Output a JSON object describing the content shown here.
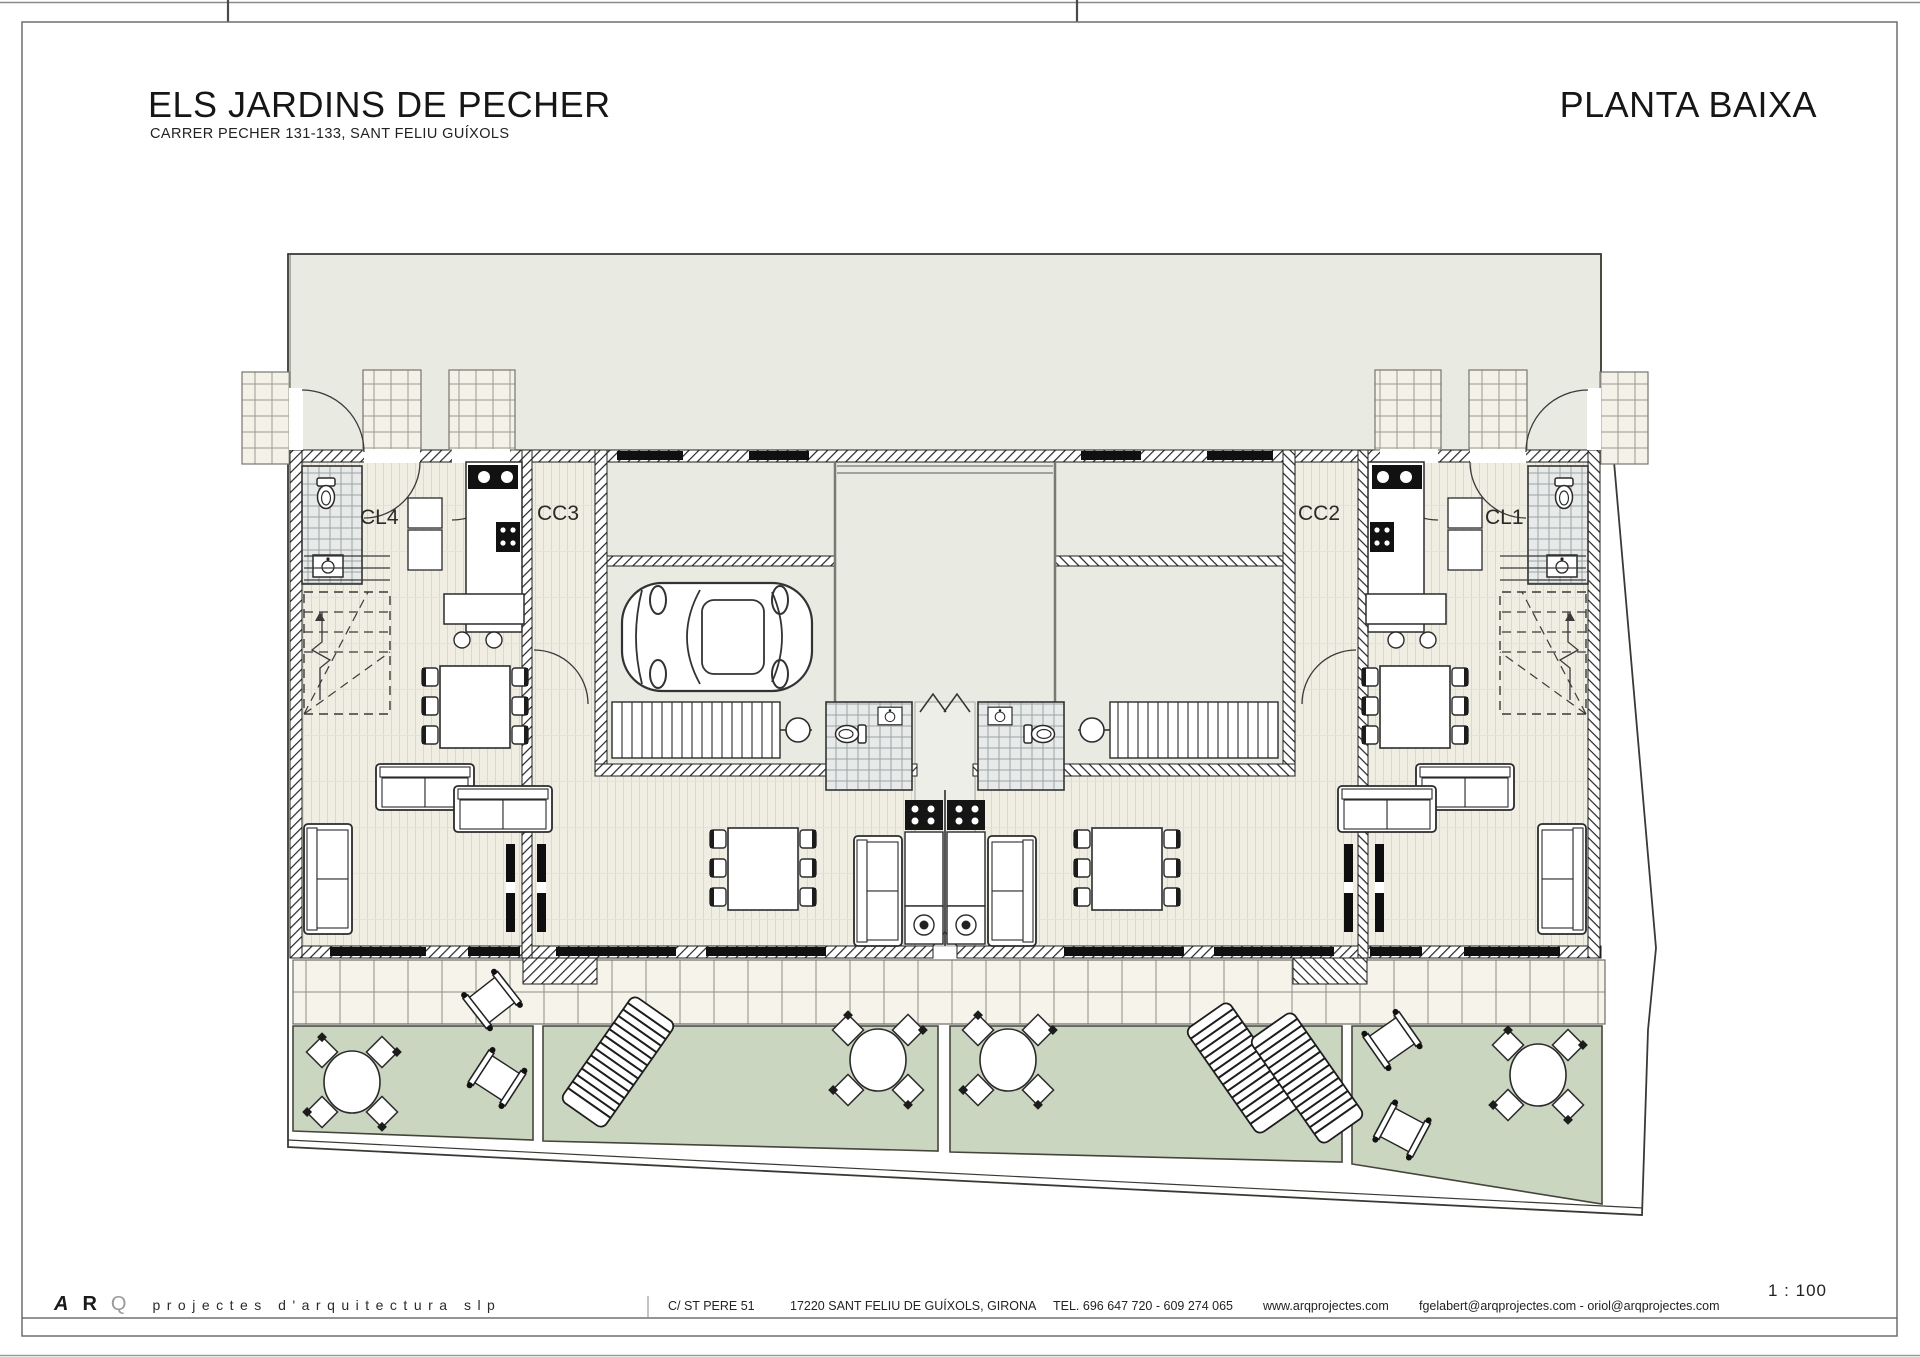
{
  "header": {
    "title": "ELS JARDINS DE PECHER",
    "subtitle": "CARRER PECHER 131-133, SANT FELIU GUÍXOLS",
    "plan_name": "PLANTA BAIXA"
  },
  "plan": {
    "units": [
      {
        "id": "cl4",
        "label": "CL4"
      },
      {
        "id": "cc3",
        "label": "CC3"
      },
      {
        "id": "cc2",
        "label": "CC2"
      },
      {
        "id": "cl1",
        "label": "CL1"
      }
    ],
    "features": [
      "garage-car",
      "central-patios",
      "stairs",
      "bathrooms",
      "kitchens",
      "dining-tables",
      "sofas",
      "garden-terraces",
      "round-tables",
      "sun-loungers"
    ]
  },
  "scale": {
    "label": "1 : 100"
  },
  "footer": {
    "logo_a": "A",
    "logo_r": "R",
    "logo_q": "Q",
    "logo_text": "projectes d'arquitectura slp",
    "address": "C/ ST PERE 51",
    "city": "17220 SANT FELIU DE GUÍXOLS, GIRONA",
    "phone": "TEL. 696 647 720 - 609 274 065",
    "web": "www.arqprojectes.com",
    "emails": "fgelabert@arqprojectes.com - oriol@arqprojectes.com"
  },
  "colors": {
    "paper": "#ffffff",
    "backdrop_grey": "#e9eae2",
    "wood_floor": "#f0ede3",
    "terrace_tile": "#f5f3ea",
    "bath_tile": "#e7eae8",
    "garden_green": "#cbd6c0",
    "wall_ink": "#1f1f1f"
  }
}
